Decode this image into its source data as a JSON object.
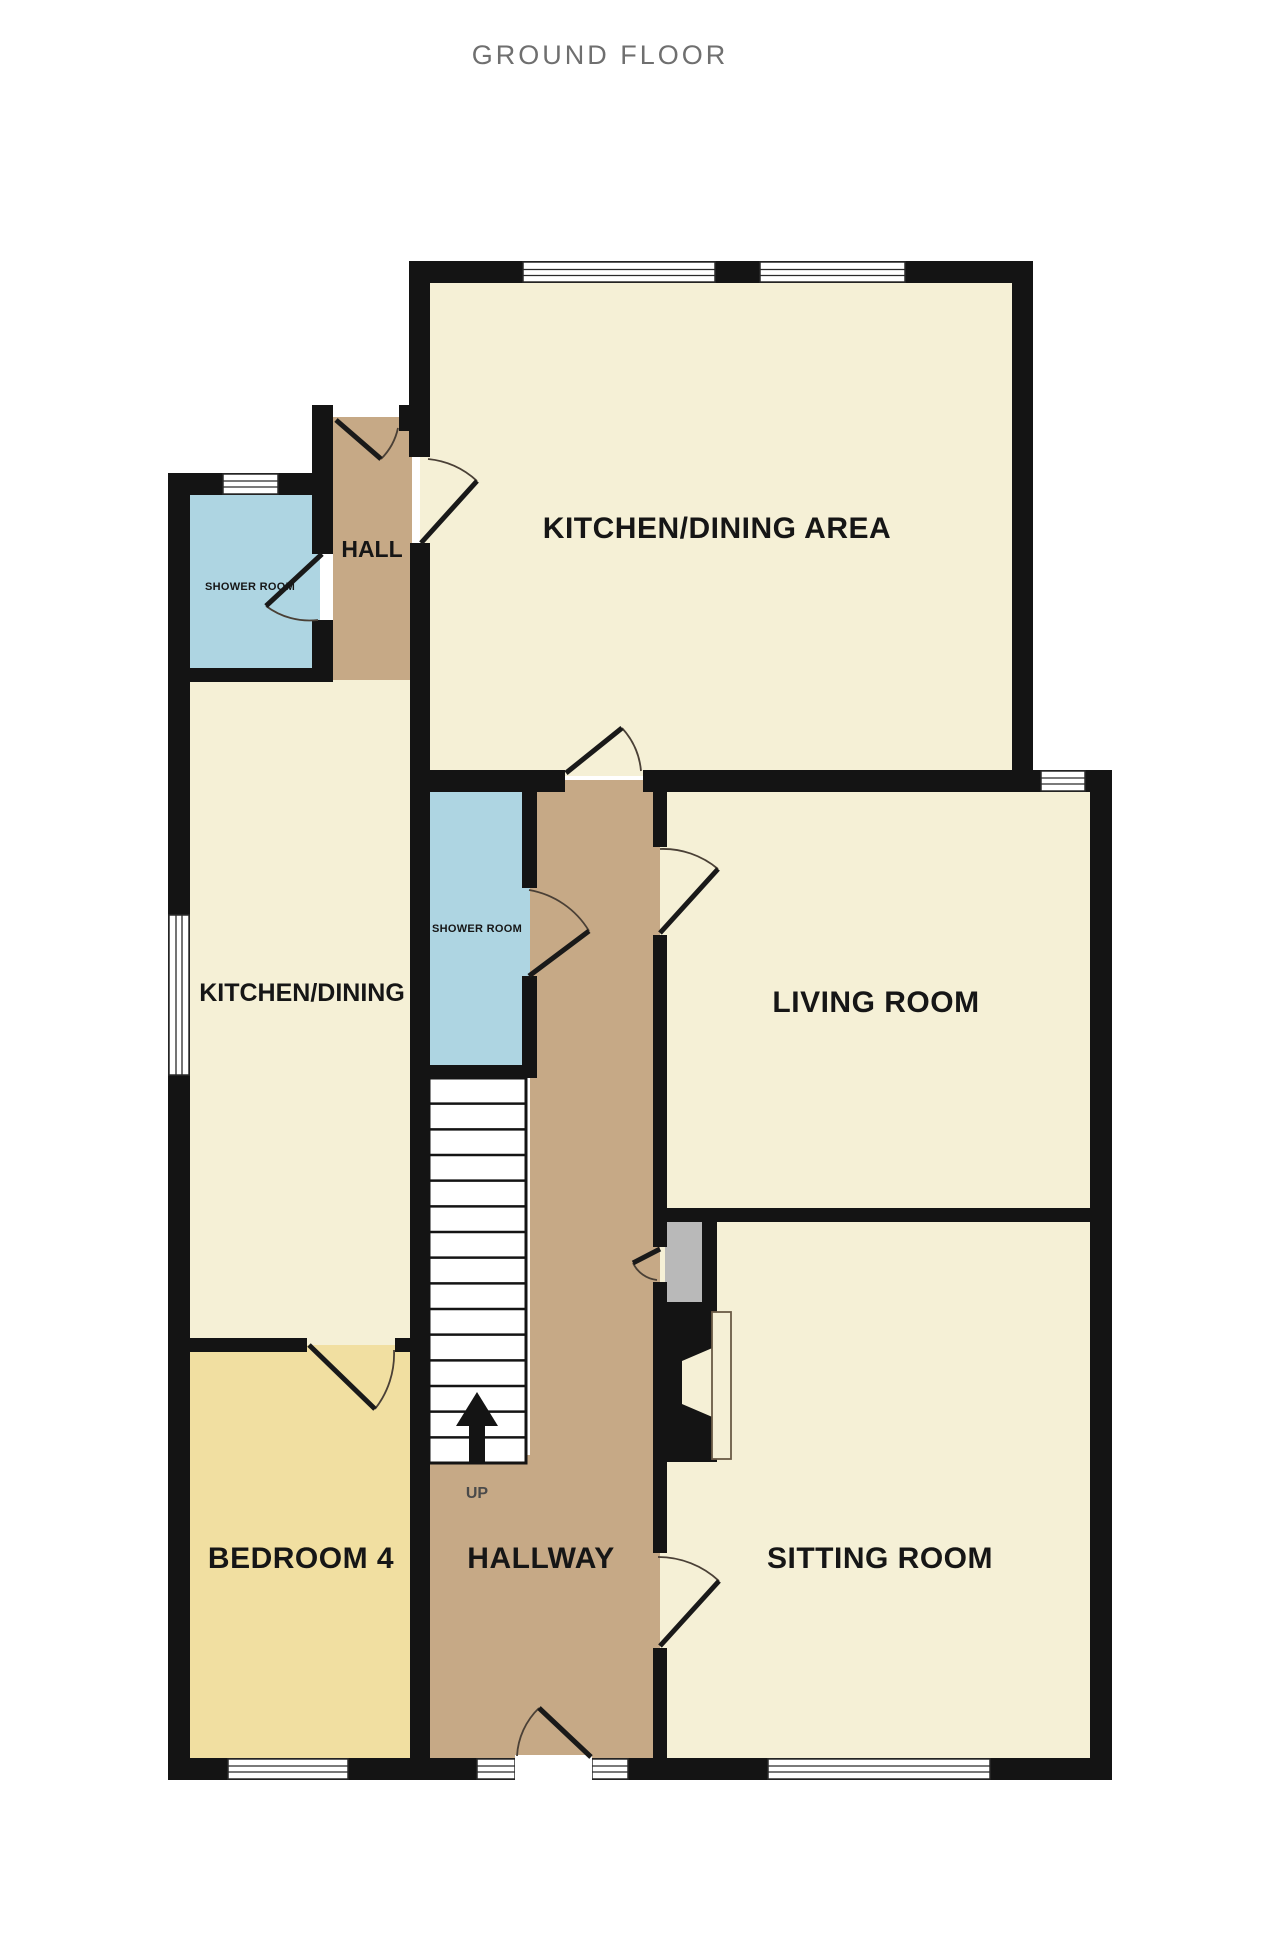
{
  "title": "GROUND FLOOR",
  "rooms": {
    "kitchen_dining_area": {
      "label": "KITCHEN/DINING AREA"
    },
    "hall": {
      "label": "HALL"
    },
    "shower_room_top": {
      "label": "SHOWER ROOM"
    },
    "kitchen_dining": {
      "label": "KITCHEN/DINING"
    },
    "shower_room_middle": {
      "label": "SHOWER ROOM"
    },
    "living_room": {
      "label": "LIVING ROOM"
    },
    "bedroom_4": {
      "label": "BEDROOM 4"
    },
    "hallway": {
      "label": "HALLWAY"
    },
    "sitting_room": {
      "label": "SITTING ROOM"
    }
  },
  "stairs": {
    "label": "UP",
    "tread_count": 15
  },
  "colors": {
    "wall": "#141414",
    "room_cream": "#f5f0d6",
    "room_yellow": "#f1dfa1",
    "room_blue": "#aed5e2",
    "circulation_tan": "#c6a986",
    "cupboard_gray": "#b9b9b9",
    "title_gray": "#6f6f6f",
    "label_black": "#161616"
  }
}
